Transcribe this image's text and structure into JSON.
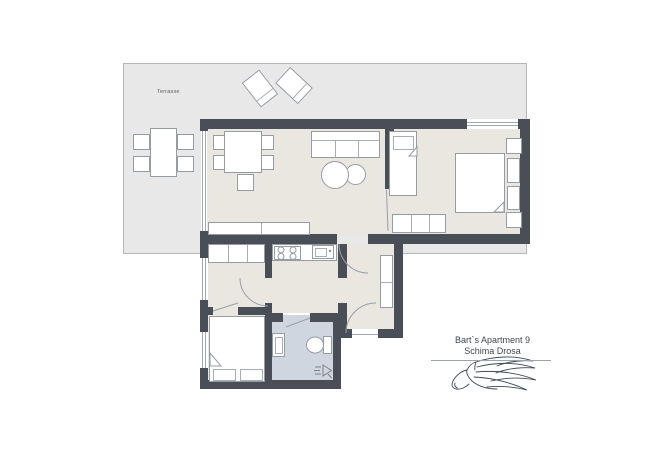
{
  "branding": {
    "line1": "Bart`s Apartment 9",
    "line2": "Schima Drosa",
    "logo_icon": "horse-logo"
  },
  "terrace": {
    "label": "Terrasse"
  },
  "colors": {
    "wall": "#4a4f57",
    "room_floor": "#e9e7e0",
    "terrace_floor": "#e8e8e8",
    "bathroom_floor": "#cfd6e0",
    "furniture_outline": "#969ca4",
    "logo_ink": "#3e4a5a"
  }
}
